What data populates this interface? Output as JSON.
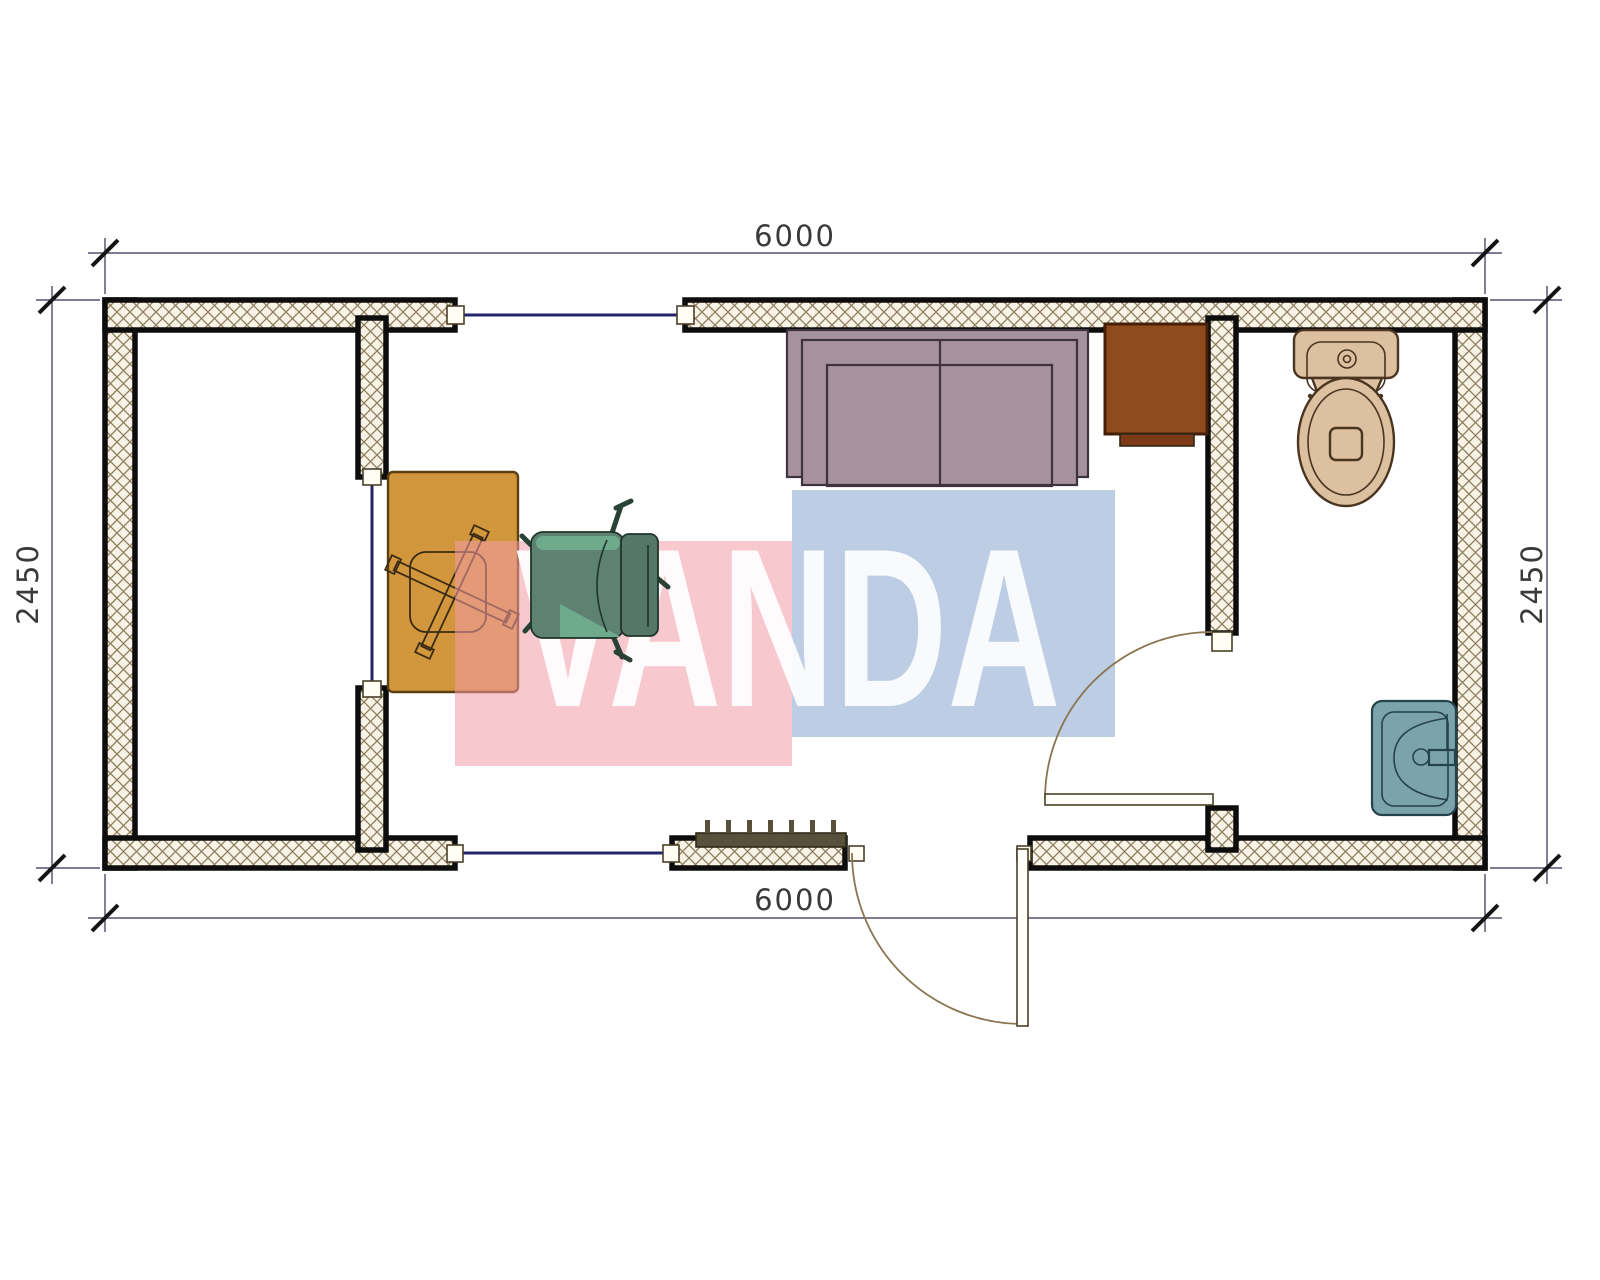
{
  "dims": {
    "top": "6000",
    "bottom": "6000",
    "left": "2450",
    "right": "2450"
  },
  "watermark": {
    "text": "VANDA",
    "pink_color": "rgba(242,155,168,0.55)",
    "blue_color": "rgba(121,155,201,0.5)",
    "text_color": "rgba(255,255,255,0.9)"
  },
  "plan": {
    "objects": [
      "left-room",
      "office-room",
      "bathroom",
      "desk",
      "desk-chair-base",
      "office-chair",
      "sofa",
      "cabinet",
      "toilet",
      "sink",
      "radiator",
      "window-top",
      "window-partition",
      "window-bottom",
      "bathroom-door",
      "entrance-door"
    ],
    "colors": {
      "wall_fill": "#f8f3e6",
      "wall_hatch": "#8d7d5e",
      "wall_outline": "#0d0d0d",
      "window_line": "#24246e",
      "dimension_line": "#2e2e52",
      "dimension_text": "#3a3a3a",
      "desk": "#d2973c",
      "desk_star": "#c9a262",
      "chair_seat": "#5d8272",
      "chair_highlight": "#6faa8c",
      "chair_back": "#557767",
      "sofa": "#a6929e",
      "cabinet": "#8f4a1e",
      "cabinet_step": "#7c3b16",
      "toilet": "#dcc0a0",
      "sink": "#7ba3ab",
      "radiator": "#57503a",
      "door_swing": "#8a7550"
    }
  }
}
